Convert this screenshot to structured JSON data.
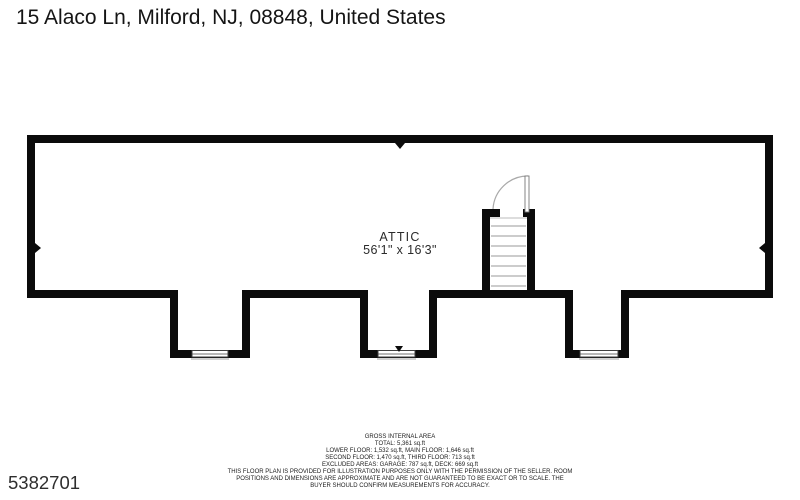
{
  "title": "15 Alaco Ln, Milford, NJ, 08848, United States",
  "plan": {
    "room_label": "ATTIC",
    "room_dimensions": "56'1\" x 16'3\"",
    "features": [
      "staircase-with-door",
      "dormer-window-1",
      "dormer-window-2",
      "dormer-window-3"
    ]
  },
  "footer": {
    "lines": [
      "GROSS INTERNAL AREA",
      "TOTAL: 5,361 sq.ft",
      "LOWER FLOOR: 1,532 sq.ft, MAIN FLOOR: 1,646 sq.ft",
      "SECOND FLOOR: 1,470 sq.ft, THIRD FLOOR: 713 sq.ft",
      "EXCLUDED AREAS: GARAGE: 787 sq.ft, DECK: 669 sq.ft",
      "THIS FLOOR PLAN IS PROVIDED FOR ILLUSTRATION PURPOSES ONLY WITH THE PERMISSION OF THE SELLER. ROOM",
      "POSITIONS AND DIMENSIONS ARE APPROXIMATE AND ARE NOT GUARANTEED TO BE EXACT OR TO SCALE. THE",
      "BUYER SHOULD CONFIRM MEASUREMENTS FOR ACCURACY."
    ]
  },
  "photo_id": "5382701",
  "colors": {
    "wall": "#0b0b0b",
    "text": "#1c1c1c",
    "door_arc": "#a9a9a9",
    "tread": "#9a9a9a",
    "window_frame": "#3f3f3f",
    "sill": "#c2c2c2"
  }
}
